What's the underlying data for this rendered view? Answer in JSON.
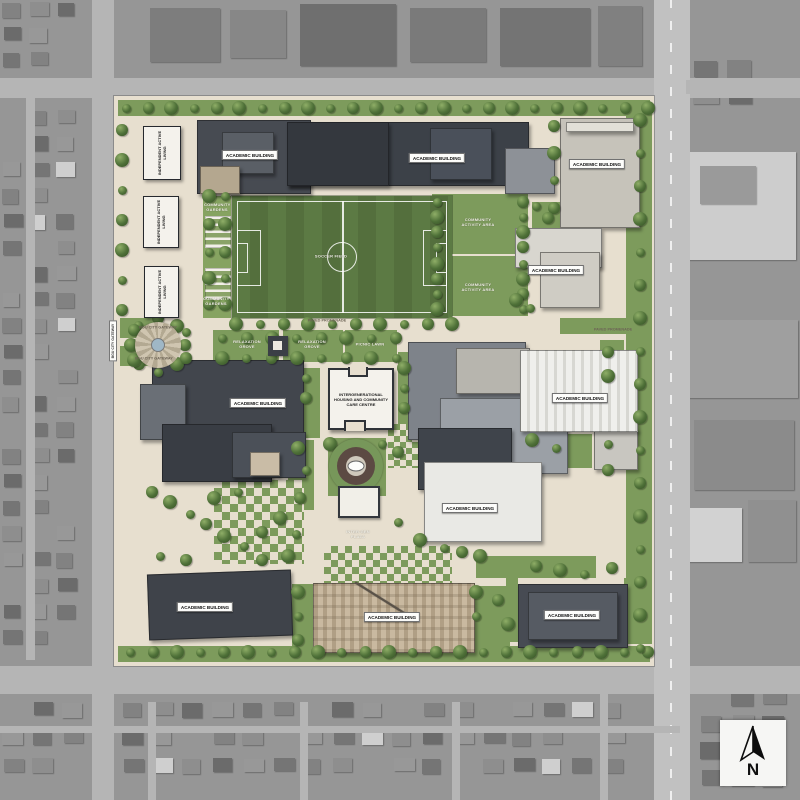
{
  "page": {
    "type": "campus-master-plan-aerial-overlay"
  },
  "plan_labels": {
    "academic_building": "ACADEMIC BUILDING",
    "independent_active_living": "INDEPENDENT ACTIVE LIVING",
    "intergenerational_centre": "INTERGENERATIONAL HOUSING AND COMMUNITY CARE CENTRE",
    "soccer_field": "SOCCER FIELD",
    "community_activity_area": "COMMUNITY ACTIVITY AREA",
    "community_gardens": "COMMUNITY GARDENS",
    "inter_gen_plaza": "INTER-GEN PLAZA",
    "relaxation_grove": "RELAXATION GROVE",
    "picnic_lawn": "PICNIC LAWN",
    "paved_promenade": "PAVED PROMENADE",
    "bgu_city_gateway": "BGU CITY GATEWAY"
  },
  "compass": {
    "north": "N"
  },
  "colors": {
    "campus_paving": "#e7dfcf",
    "lawn_green": "#7d9b5c",
    "field_green": "#5c7a44",
    "roof_dark": "#3f444b",
    "roof_light": "#c6c3ba",
    "aerial_gray": "#969696",
    "label_background": "#fdfdfb",
    "label_text": "#111111"
  }
}
